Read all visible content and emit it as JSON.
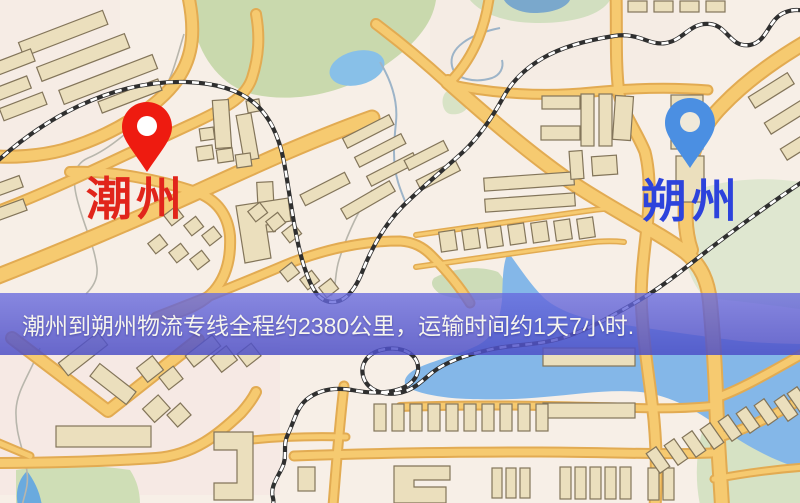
{
  "map": {
    "origin_label": "潮州",
    "destination_label": "朔州",
    "origin_label_color": "#e1251b",
    "destination_label_color": "#2d43dc",
    "origin_pin_color": "#ee1b10",
    "destination_pin_color": "#4b8fe2",
    "road_color": "#f6ca70",
    "water_color": "#84b7e8",
    "park_color": "#c9d9ad"
  },
  "banner": {
    "text": "潮州到朔州物流专线全程约2380公里，运输时间约1天7小时.",
    "background_color": "#5a5ccd",
    "text_color": "#f6f5ee"
  }
}
